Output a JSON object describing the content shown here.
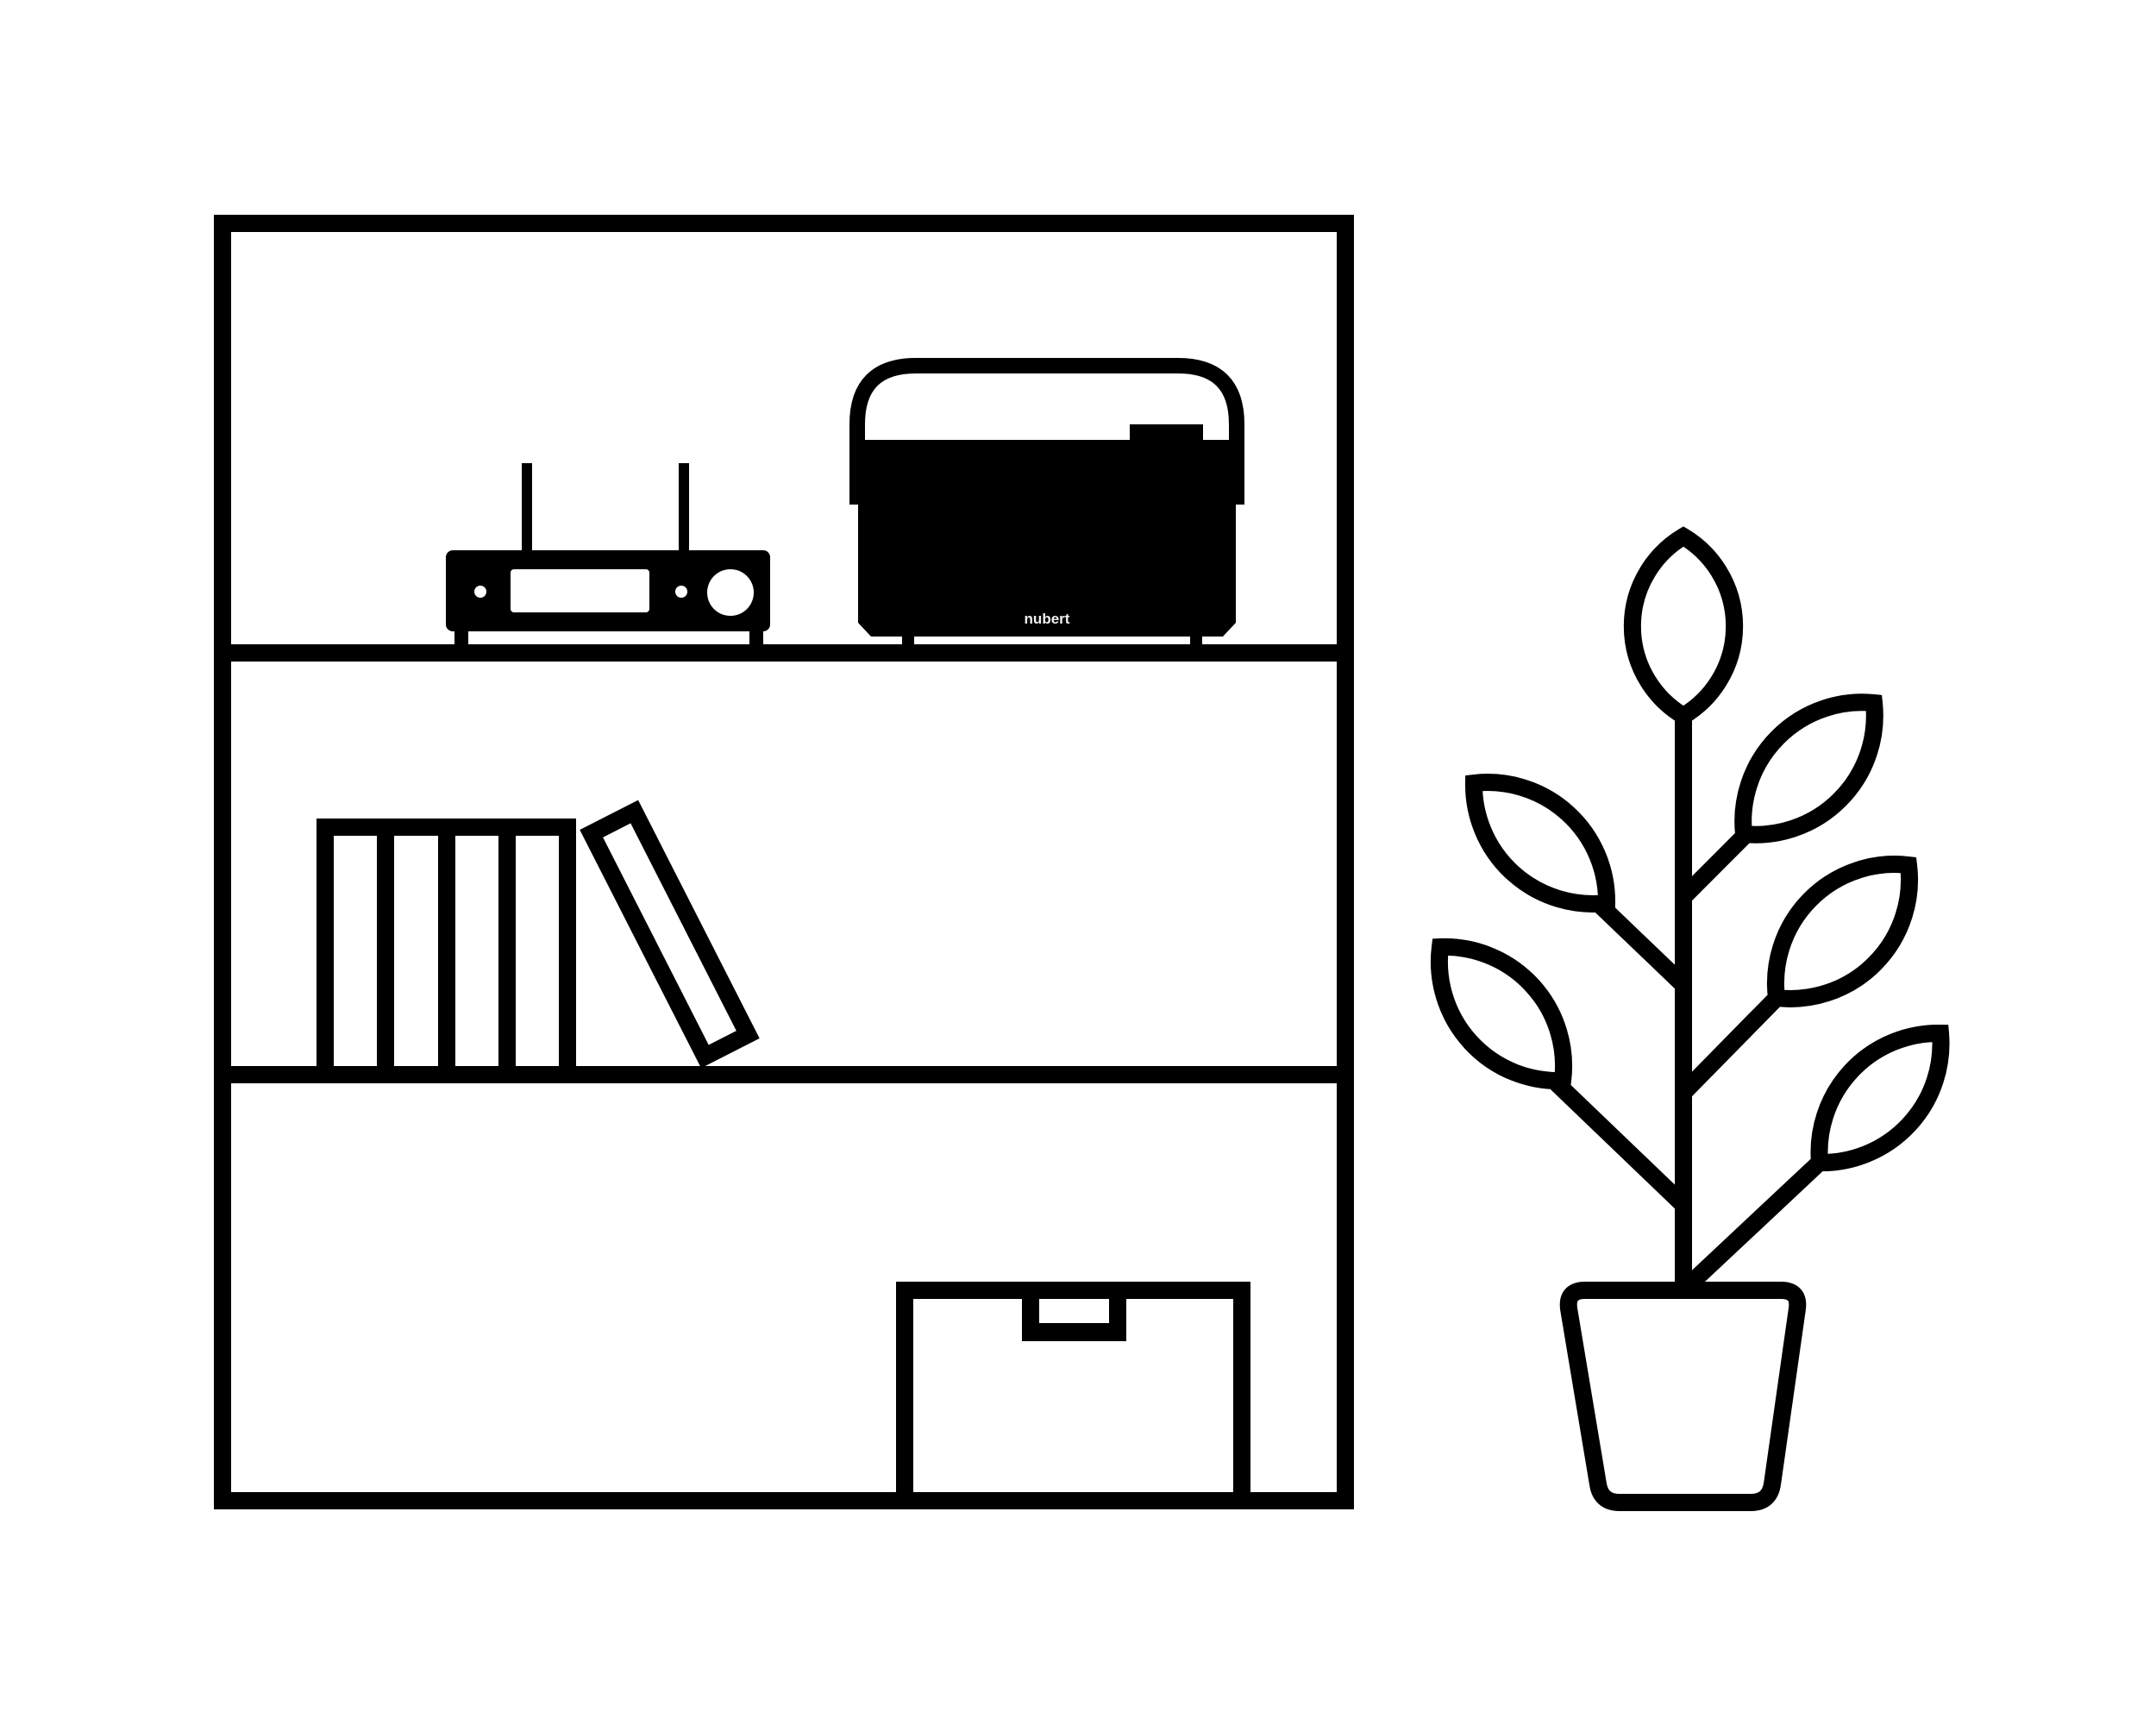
{
  "illustration": {
    "background_color": "#ffffff",
    "ink_color": "#000000",
    "bookshelf": {
      "shelf_count": 3,
      "receiver": {
        "antenna_count": 2,
        "knob_count": 1
      },
      "speaker": {
        "brand_label": "nubert",
        "label_color": "#f0f0f0"
      },
      "books": {
        "standing_count": 4,
        "leaning_count": 1
      }
    },
    "plant": {
      "leaf_count": 6
    }
  }
}
